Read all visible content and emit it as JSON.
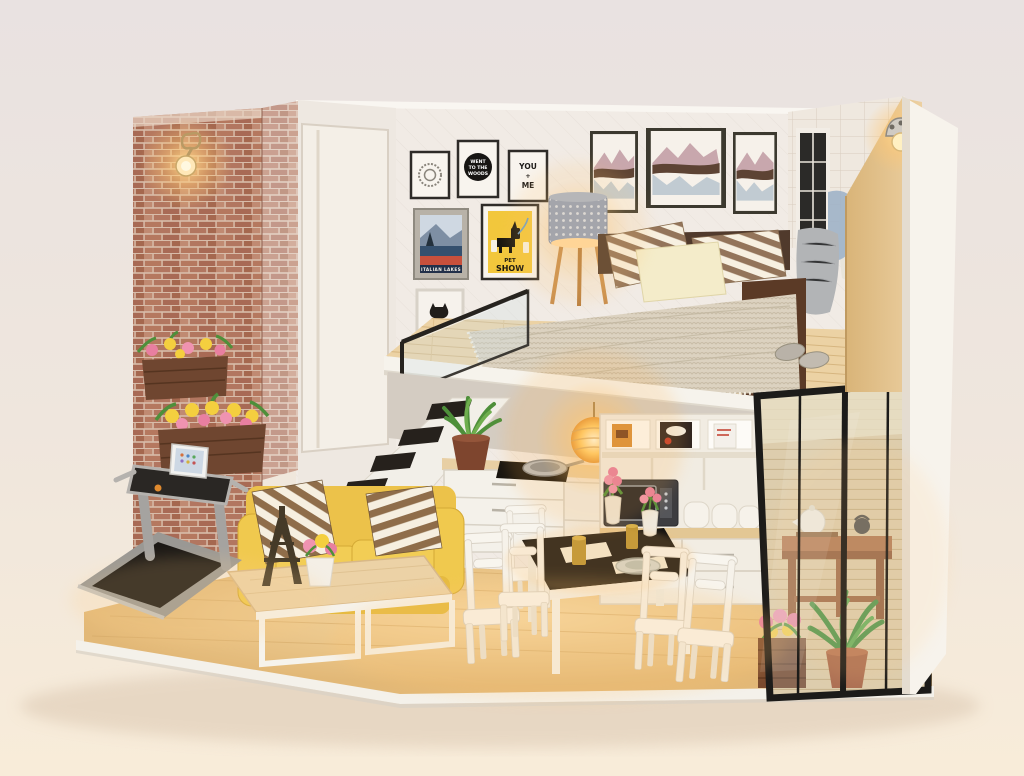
{
  "scene": {
    "background_top": "#e9e2e1",
    "background_bottom": "#f8ecd9",
    "warm_light": "#ffc97a"
  },
  "posters": {
    "went_to_the_woods": {
      "line1": "WENT",
      "line2": "TO THE",
      "line3": "WOODS"
    },
    "you_me": {
      "line1": "YOU",
      "line2": "+",
      "line3": "ME"
    },
    "pet_show": {
      "line1": "PET",
      "line2": "SHOW"
    },
    "italian_lakes": {
      "label": "ITALIAN LAKES"
    }
  },
  "palette": {
    "brick": "#b5806c",
    "sofa_yellow": "#ecc24a",
    "wood_floor": "#e7c084",
    "loft_wood": "#ecd2a4",
    "glass_frame": "#1d1b19",
    "wall_white": "#f1ebe5",
    "stripe_brown": "#8f6d4a",
    "blanket_knit": "#dcd2c0",
    "plant_green": "#4e8f3a",
    "flower_pink": "#e87fa0",
    "flower_yellow": "#f4cf3f"
  }
}
